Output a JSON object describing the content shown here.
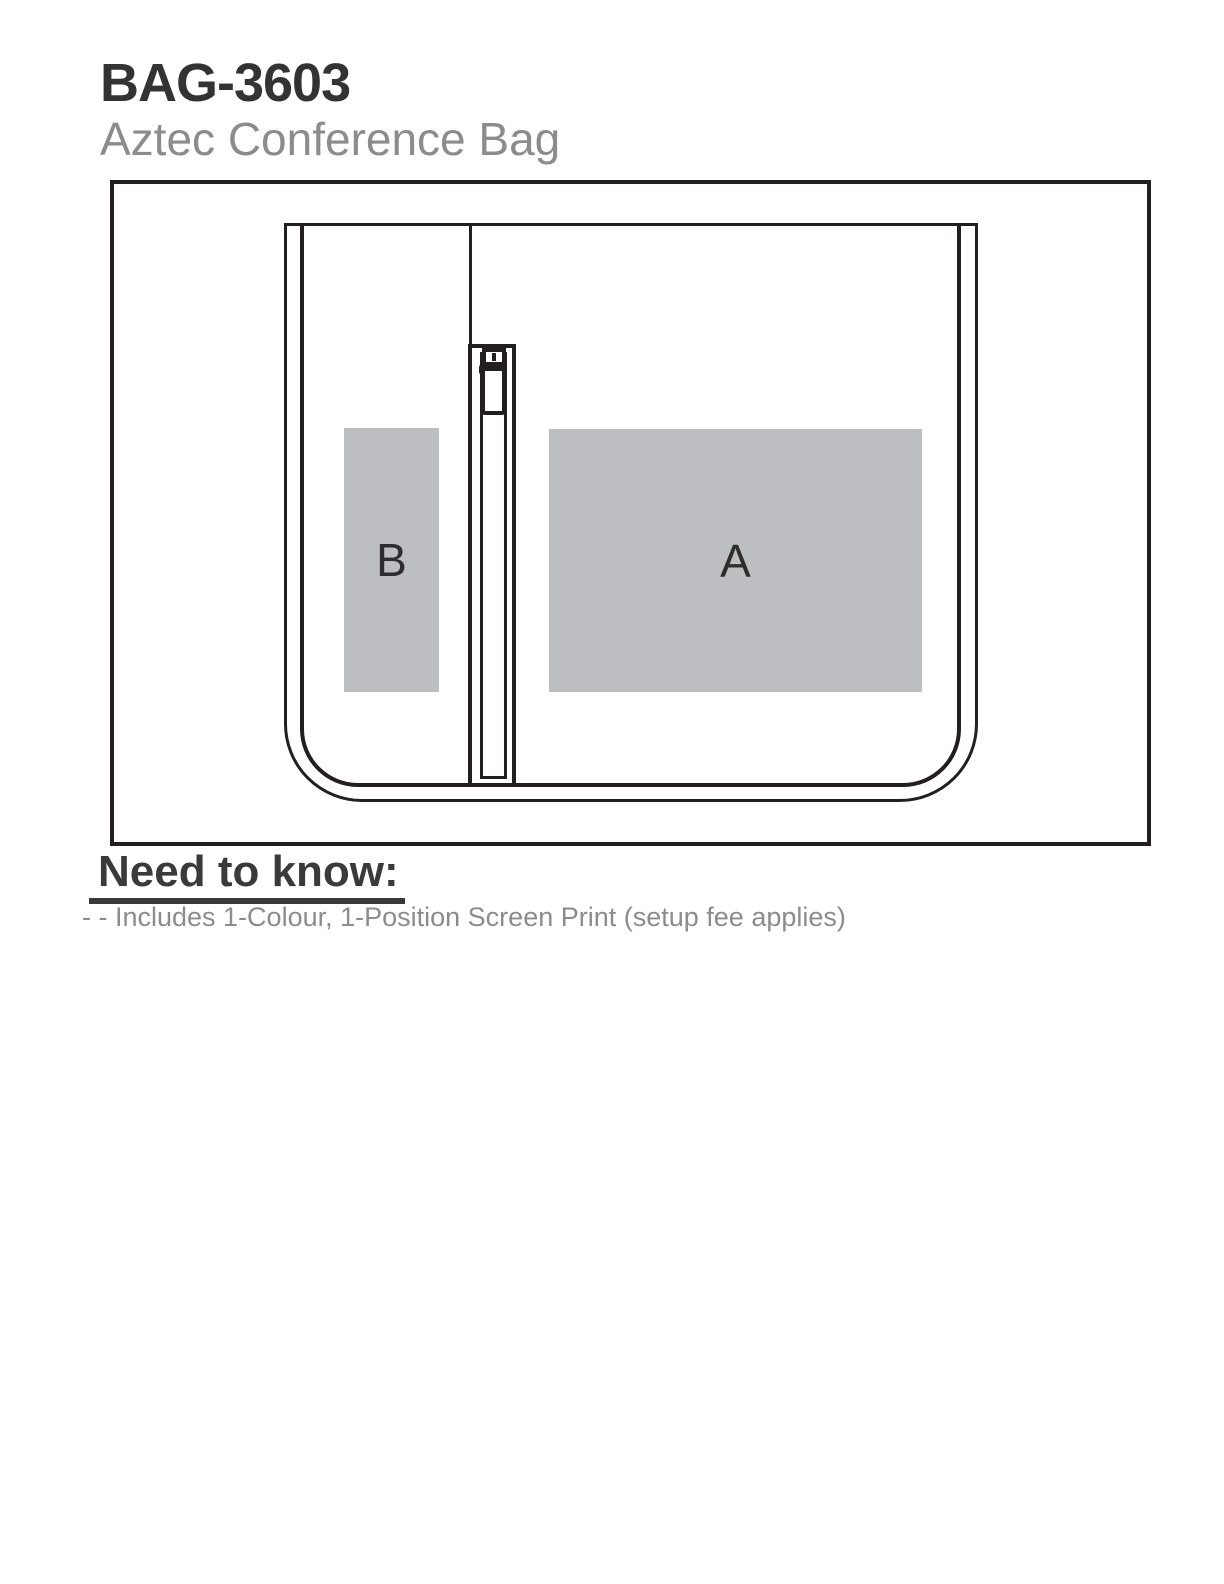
{
  "header": {
    "sku": "BAG-3603",
    "product_name": "Aztec Conference Bag"
  },
  "diagram": {
    "line_color": "#231f20",
    "print_area_fill": "#bdbec2",
    "print_areas": [
      {
        "id": "A",
        "label": "A"
      },
      {
        "id": "B",
        "label": "B"
      }
    ]
  },
  "need_to_know": {
    "heading": "Need to know:",
    "notes": [
      "- - Includes 1-Colour, 1-Position Screen Print (setup fee applies)"
    ]
  }
}
